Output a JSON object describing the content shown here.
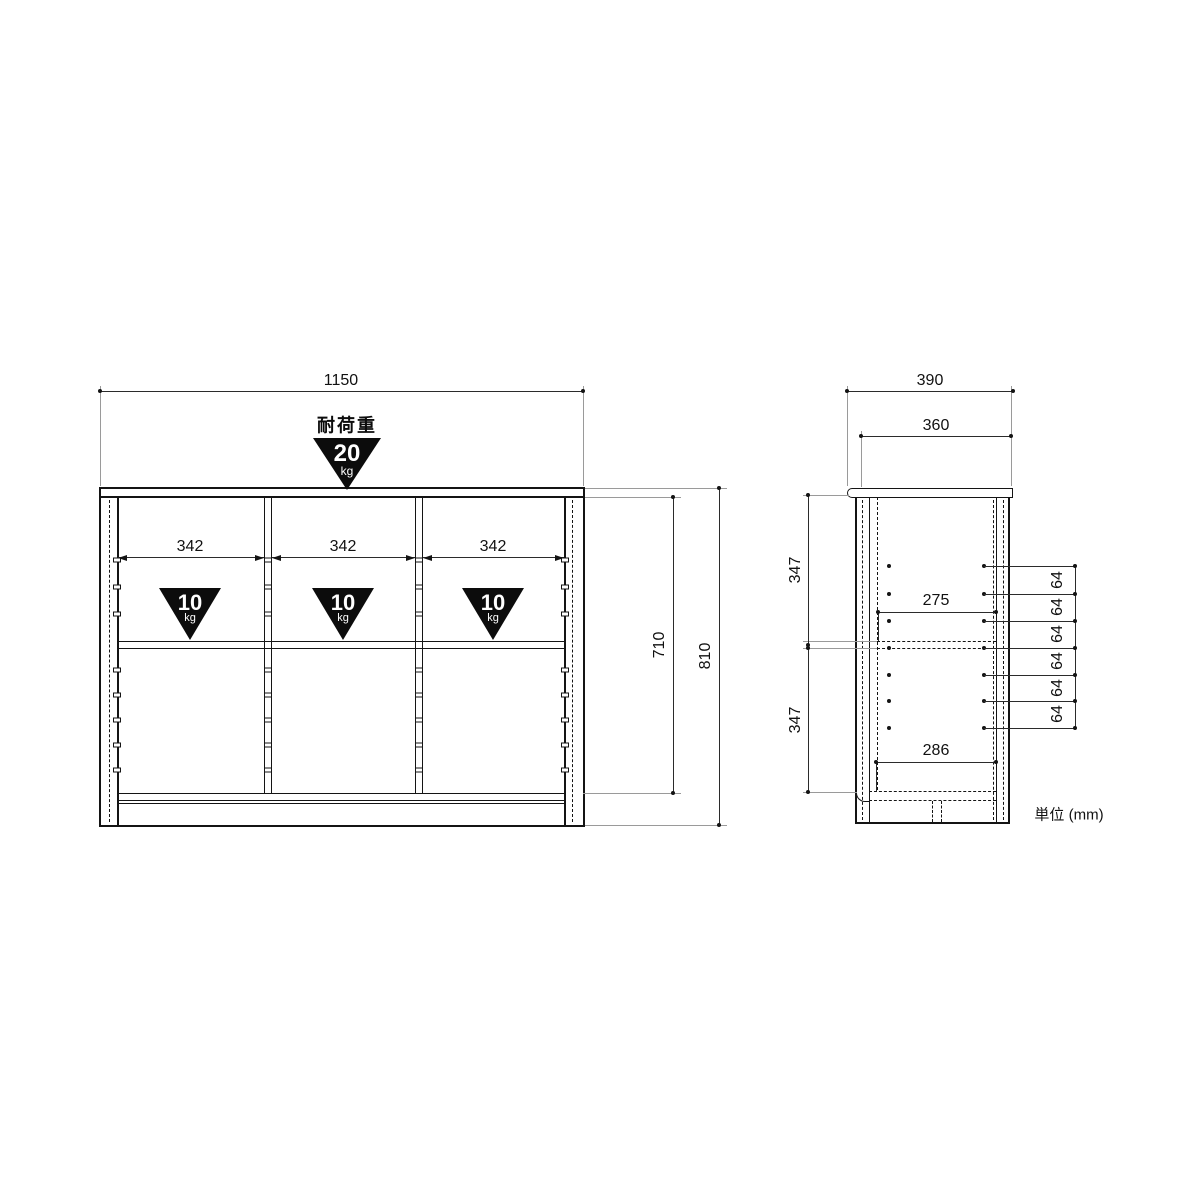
{
  "unit_note": "単位 (mm)",
  "front_view": {
    "overall_width": "1150",
    "overall_height": "810",
    "inner_height": "710",
    "top_load_label": "耐荷重",
    "top_load_value": "20",
    "top_load_unit": "kg",
    "bays": [
      {
        "inner_width": "342",
        "load_value": "10",
        "load_unit": "kg"
      },
      {
        "inner_width": "342",
        "load_value": "10",
        "load_unit": "kg"
      },
      {
        "inner_width": "342",
        "load_value": "10",
        "load_unit": "kg"
      }
    ]
  },
  "side_view": {
    "overall_depth": "390",
    "top_depth": "360",
    "upper_section_height": "347",
    "lower_section_height": "347",
    "upper_inner_depth": "275",
    "lower_inner_depth": "286",
    "shelf_pin_pitches": [
      "64",
      "64",
      "64",
      "64",
      "64",
      "64"
    ]
  },
  "colors": {
    "object_line": "#141414",
    "dimension_line": "#2b2b2b",
    "extension_line": "#9a9a9a",
    "badge_background": "#0c0c0c",
    "badge_text": "#ffffff",
    "paper": "#ffffff"
  }
}
